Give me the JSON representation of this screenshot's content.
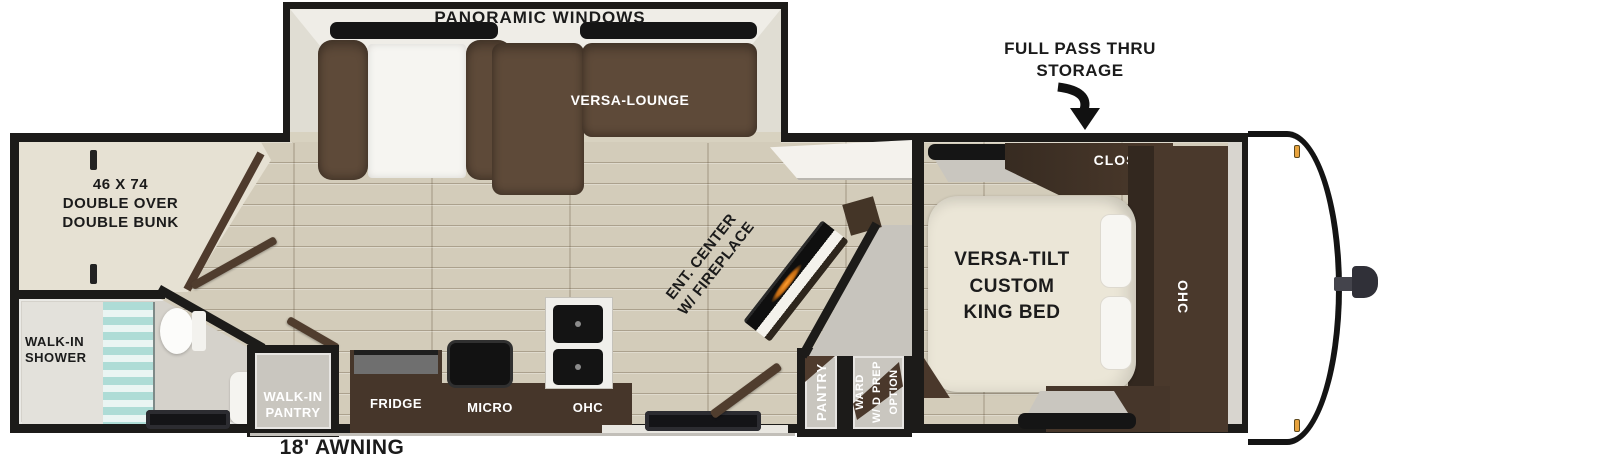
{
  "floorplan": {
    "type": "travel-trailer floor plan",
    "colors": {
      "wall": "#1c1b19",
      "floor_wood": "#d3ccba",
      "sofa_brown": "#5e4a39",
      "cabinet_brown": "#46362a",
      "bed_cream": "#ebe6d7",
      "room_gray": "#c9c6bf",
      "shower_glass": "#aedcd6",
      "fireplace_glow": "#ff9d2e",
      "marker_light": "#e8a33d"
    },
    "labels": {
      "panoramic_windows": "PANORAMIC WINDOWS",
      "versa_lounge": "VERSA-LOUNGE",
      "full_pass_thru": {
        "line1": "FULL PASS THRU",
        "line2": "STORAGE"
      },
      "bunk": {
        "line1": "46 X 74",
        "line2": "DOUBLE OVER",
        "line3": "DOUBLE BUNK"
      },
      "shower": {
        "line1": "WALK-IN",
        "line2": "SHOWER"
      },
      "walk_in_pantry": {
        "line1": "WALK-IN",
        "line2": "PANTRY"
      },
      "fridge": "FRIDGE",
      "micro": "MICRO",
      "kitchen_ohc": "OHC",
      "ent_center": {
        "line1": "ENT. CENTER",
        "line2": "W/ FIREPLACE"
      },
      "pantry": "PANTRY",
      "ward": {
        "line1": "WARD",
        "line2": "W/ D PREP",
        "line3": "OPTION"
      },
      "closet": "CLOSET",
      "bedroom_ohc": "OHC",
      "king_bed": {
        "line1": "VERSA-TILT",
        "line2": "CUSTOM",
        "line3": "KING BED"
      },
      "awning": "18' AWNING"
    }
  }
}
